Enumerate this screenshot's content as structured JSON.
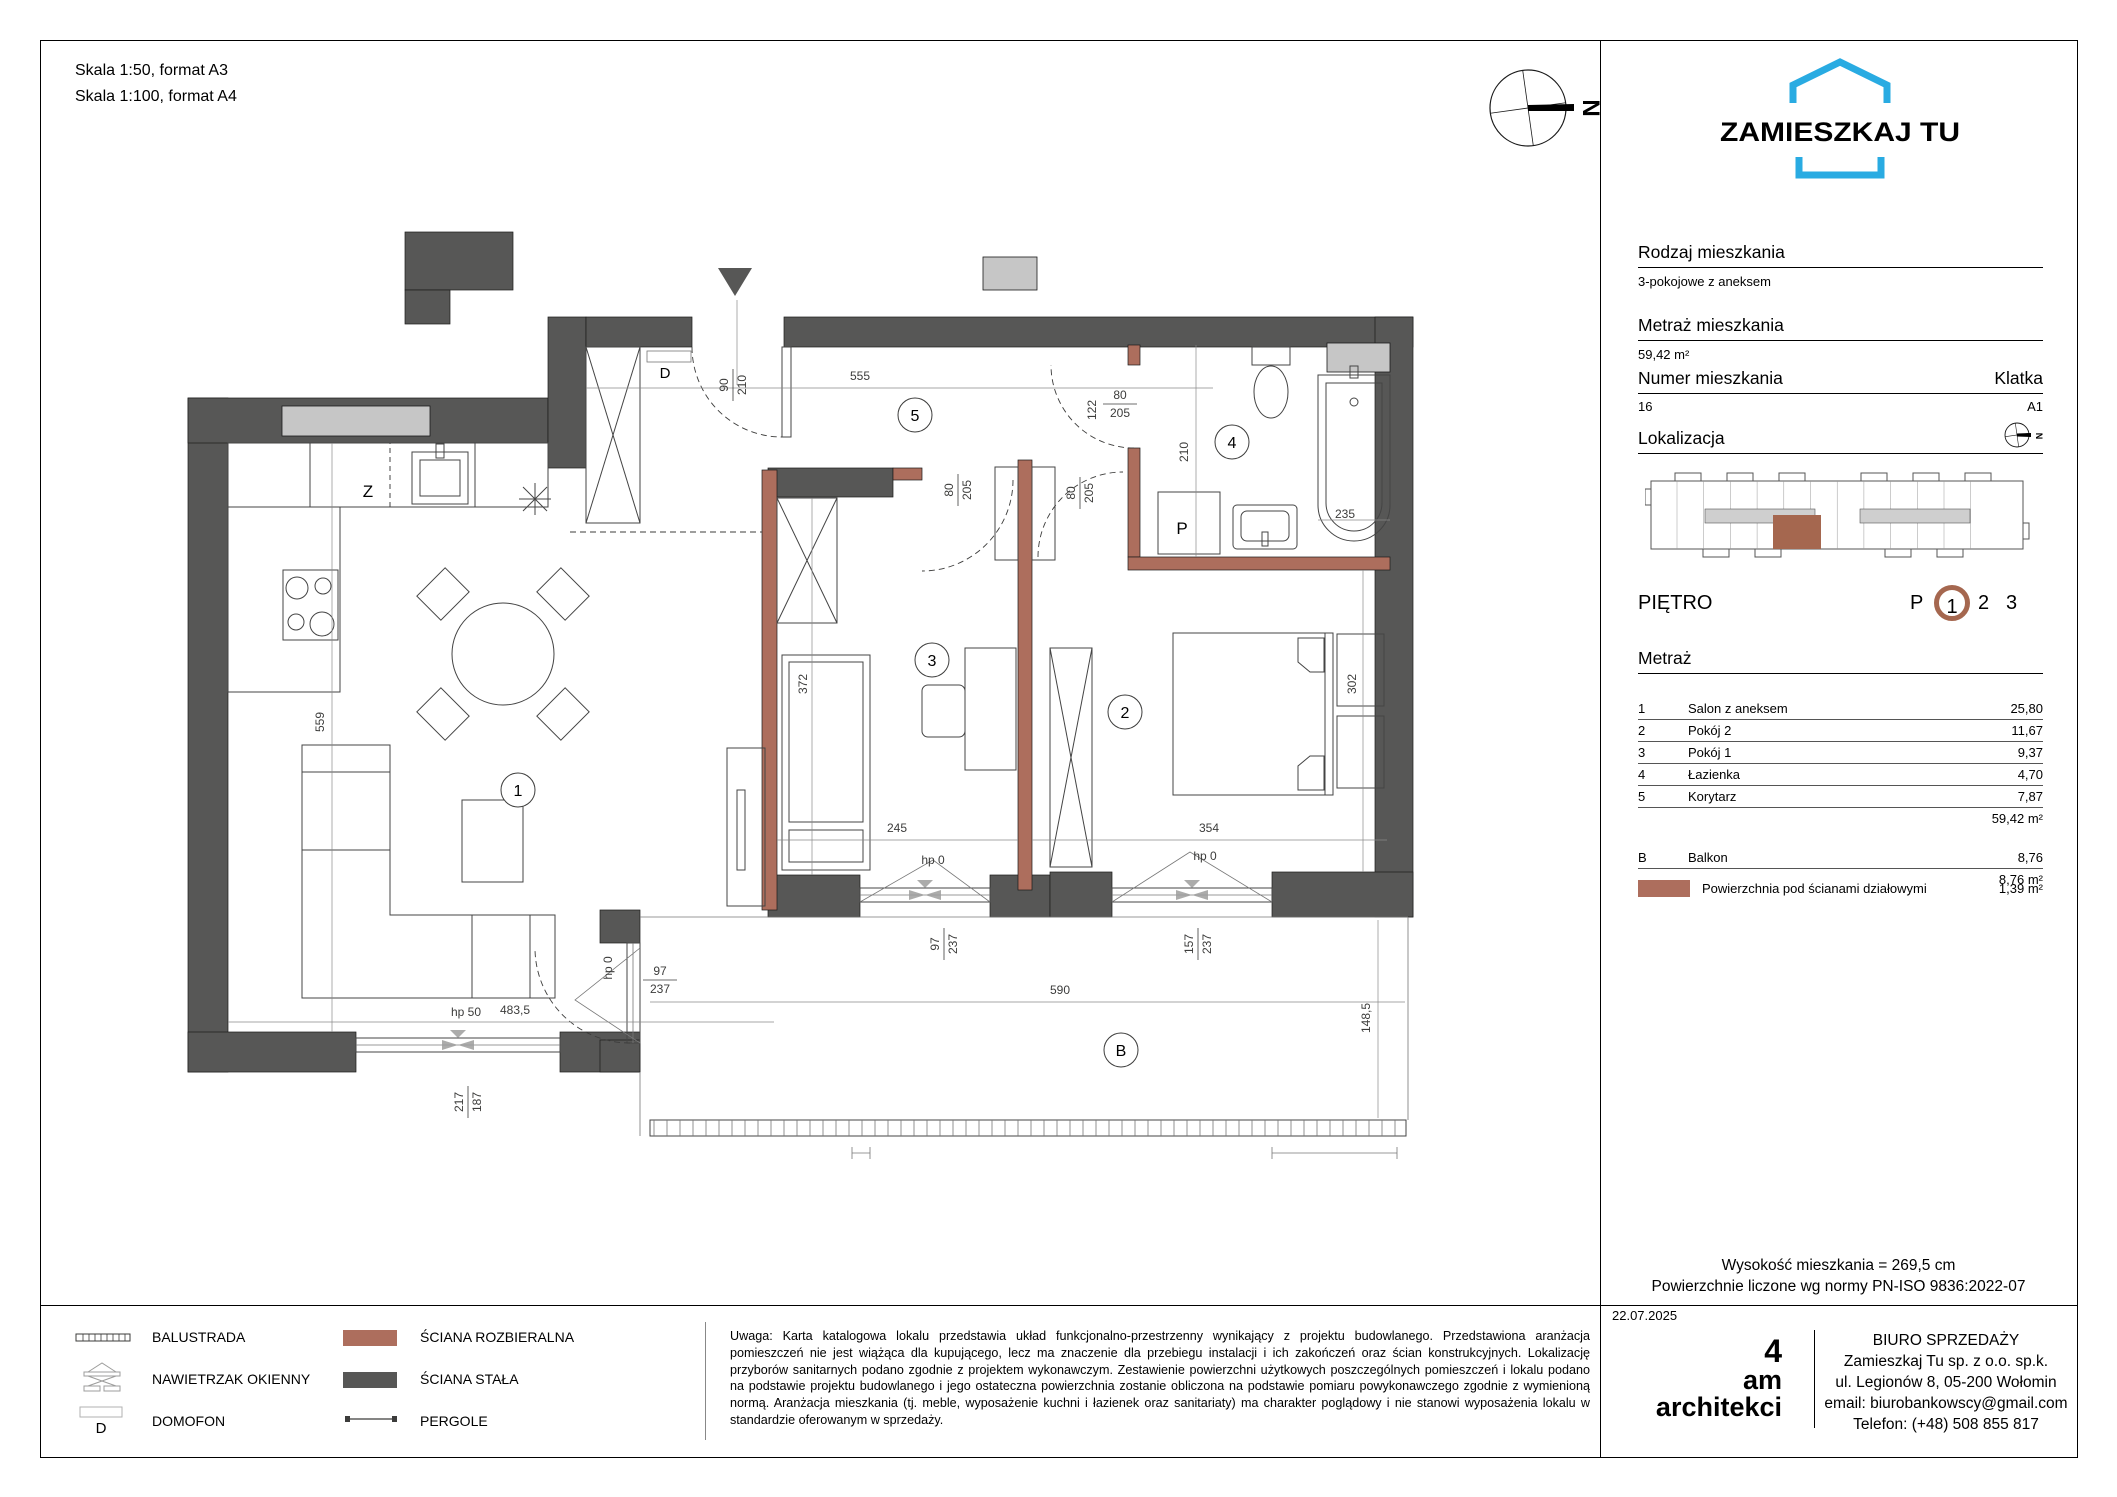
{
  "colors": {
    "accent_blue": "#29abe2",
    "wall_dark": "#575756",
    "wall_brown": "#ad6e5d",
    "shaft_grey": "#c6c6c6",
    "ring_brown": "#a5674f"
  },
  "header": {
    "scale1": "Skala 1:50, format A3",
    "scale2": "Skala 1:100, format A4"
  },
  "sidebar": {
    "brand": "ZAMIESZKAJ TU",
    "rodzaj_label": "Rodzaj mieszkania",
    "rodzaj_value": "3-pokojowe z aneksem",
    "metraz_label": "Metraż mieszkania",
    "metraz_value": "59,42 m²",
    "numer_label": "Numer mieszkania",
    "numer_value": "16",
    "klatka_label": "Klatka",
    "klatka_value": "A1",
    "lokalizacja_label": "Lokalizacja",
    "pietro_label": "PIĘTRO",
    "pietro_p": "P",
    "pietro_1": "1",
    "pietro_2": "2",
    "pietro_3": "3",
    "metraz_table_label": "Metraż",
    "rooms": [
      {
        "no": "1",
        "name": "Salon z aneksem",
        "area": "25,80"
      },
      {
        "no": "2",
        "name": "Pokój 2",
        "area": "11,67"
      },
      {
        "no": "3",
        "name": "Pokój 1",
        "area": "9,37"
      },
      {
        "no": "4",
        "name": "Łazienka",
        "area": "4,70"
      },
      {
        "no": "5",
        "name": "Korytarz",
        "area": "7,87"
      }
    ],
    "rooms_total": "59,42 m²",
    "balcony_row": {
      "no": "B",
      "name": "Balkon",
      "area": "8,76"
    },
    "balcony_total": "8,76 m²",
    "partition_label": "Powierzchnia pod ścianami działowymi",
    "partition_value": "1,39 m²",
    "height_note": "Wysokość mieszkania =  269,5 cm",
    "norm_note": "Powierzchnie liczone wg normy PN-ISO 9836:2022-07"
  },
  "plan": {
    "room_circles": {
      "r1": "1",
      "r2": "2",
      "r3": "3",
      "r4": "4",
      "r5": "5",
      "b": "B"
    },
    "labels": {
      "sink": "Z",
      "washer": "P",
      "domofon": "D",
      "north": "N"
    },
    "dims": {
      "d555": "555",
      "d90": "90",
      "d210": "210",
      "d80": "80",
      "d205": "205",
      "d122": "122",
      "d210b": "210",
      "d235": "235",
      "d372": "372",
      "d245": "245",
      "d302": "302",
      "d354": "354",
      "d559": "559",
      "d4835": "483,5",
      "d590": "590",
      "d1485": "148,5",
      "d97": "97",
      "d237": "237",
      "d157": "157",
      "d217": "217",
      "d187": "187",
      "hp50": "hp 50",
      "hp0": "hp 0"
    }
  },
  "footer": {
    "legend": {
      "balustrada": "BALUSTRADA",
      "nawietrzak": "NAWIETRZAK OKIENNY",
      "domofon": "DOMOFON",
      "sciana_rozbieralna": "ŚCIANA ROZBIERALNA",
      "sciana_stala": "ŚCIANA STAŁA",
      "pergole": "PERGOLE"
    },
    "disclaimer": "Uwaga: Karta katalogowa lokalu przedstawia układ funkcjonalno-przestrzenny wynikający z projektu budowlanego. Przedstawiona aranżacja pomieszczeń nie jest wiążąca dla kupującego, lecz ma znaczenie dla przebiegu instalacji i ich zakończeń oraz ścian konstrukcyjnych. Lokalizację przyborów sanitarnych podano zgodnie z projektem wykonawczym. Zestawienie powierzchni użytkowych poszczególnych pomieszczeń i lokalu podano na podstawie projektu budowlanego i jego ostateczna powierzchnia zostanie obliczona na podstawie pomiaru powykonawczego zgodnie z wymienioną normą. Aranżacja mieszkania (tj. meble, wyposażenie kuchni i łazienek oraz sanitariaty) ma charakter poglądowy i nie stanowi wyposażenia lokalu w standardzie oferowanym w sprzedaży.",
    "date": "22.07.2025",
    "studio_4": "4",
    "studio_am": "am",
    "studio_architekci": "architekci",
    "office_title": "BIURO SPRZEDAŻY",
    "office_company": "Zamieszkaj Tu sp. z o.o. sp.k.",
    "office_address": "ul. Legionów 8, 05-200 Wołomin",
    "office_email": "email: biurobankowscy@gmail.com",
    "office_phone": "Telefon: (+48) 508 855 817"
  }
}
